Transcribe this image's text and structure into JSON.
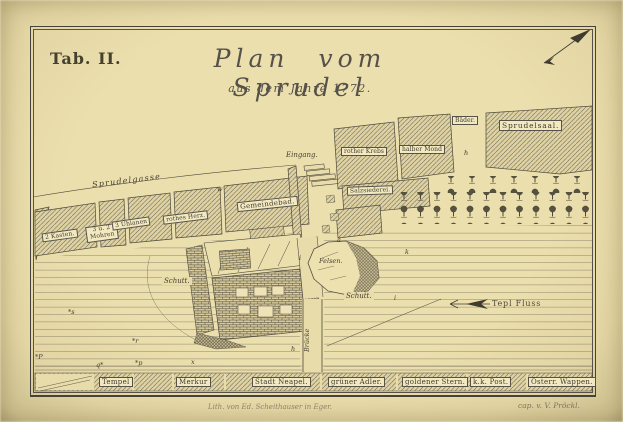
{
  "plate_label": "Tab. II.",
  "title": "Plan vom Sprudel",
  "subtitle": "aus dem Jahre 1772.",
  "colors": {
    "paper": "#e9dcab",
    "ink": "#4a463a"
  },
  "street": {
    "name": "Sprudelgasse",
    "entrance": "Eingang."
  },
  "street_buildings": [
    {
      "label": "2 Kasten."
    },
    {
      "label": "3 u. 2 Mohren"
    },
    {
      "label": "3 Uhlanen"
    },
    {
      "label": "rothes Herz."
    },
    {
      "label": "Gemeindebad."
    }
  ],
  "upper_buildings": [
    {
      "label": "rother Krebs"
    },
    {
      "label": "halber Mond"
    },
    {
      "label": "Bäder."
    },
    {
      "label": "Sprudelsaal."
    },
    {
      "label": "Salzsiederei."
    }
  ],
  "bottom_buildings": [
    {
      "label": "Tempel"
    },
    {
      "label": "Merkur"
    },
    {
      "label": "Stadt Neapel."
    },
    {
      "label": "grüner Adler."
    },
    {
      "label": "goldener Stern."
    },
    {
      "label": "k.k. Post."
    },
    {
      "label": "Österr. Wappen."
    }
  ],
  "terrain": {
    "rock": "Felsen.",
    "debris_left": "Schutt.",
    "debris_right": "Schutt.",
    "bridge": "Brücke",
    "river": "Tepl Fluss"
  },
  "ref_marks": [
    "w",
    "h",
    "a",
    "k",
    "i",
    "h",
    "*s",
    "*r",
    "*P",
    "q*",
    "*p",
    "x",
    "i"
  ],
  "credits": {
    "lithographer": "Lith. von Ed. Scheithauser in Eger.",
    "cartographer": "cap. v. V. Pröckl."
  }
}
